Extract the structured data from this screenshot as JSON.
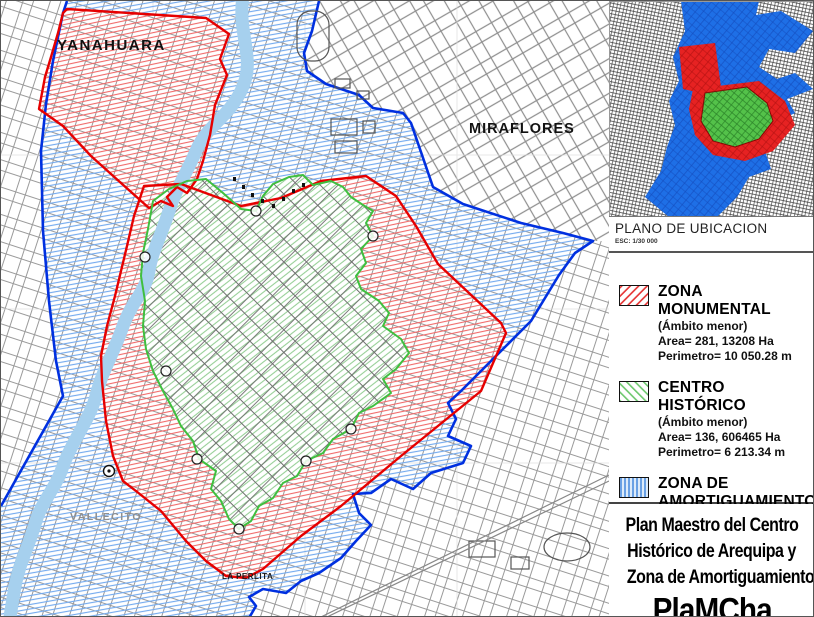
{
  "map": {
    "labels": [
      {
        "text": "YANAHUARA"
      },
      {
        "text": "MIRAFLORES"
      },
      {
        "text": "VALLECITO"
      },
      {
        "text": "LA PERLITA"
      }
    ]
  },
  "inset": {
    "caption": "PLANO DE UBICACION",
    "scale": "ESC: 1/30 000"
  },
  "legend": {
    "items": [
      {
        "name": "ZONA MONUMENTAL",
        "scope": "(Ámbito menor)",
        "area": "Area= 281, 13208 Ha",
        "perimeter": "Perimetro= 10 050.28 m",
        "swatch": "red-diagonal-hatch",
        "color": "#e60000"
      },
      {
        "name": "CENTRO HISTÓRICO",
        "scope": "(Ámbito menor)",
        "area": "Area= 136, 606465 Ha",
        "perimeter": "Perimetro= 6 213.34 m",
        "swatch": "green-diagonal-hatch",
        "color": "#3fbf3f"
      },
      {
        "name": "ZONA DE AMORTIGUAMIENTO",
        "scope": "(Ámbito mayor)",
        "area": "Area= 976.1217 Ha",
        "perimeter": "Perimetro= 22,103.56 m",
        "swatch": "blue-vertical-hatch",
        "color": "#0033e6"
      }
    ]
  },
  "title_block": {
    "lines": [
      "Plan Maestro del Centro",
      "Histórico de Arequipa y",
      "Zona de Amortiguamiento"
    ],
    "acronym": "PlaMCha"
  },
  "colors": {
    "zona_monumental_border": "#e60000",
    "centro_historico_border": "#3fbf3f",
    "amortiguamiento_border": "#0030e0",
    "river": "#a6d0ee"
  }
}
